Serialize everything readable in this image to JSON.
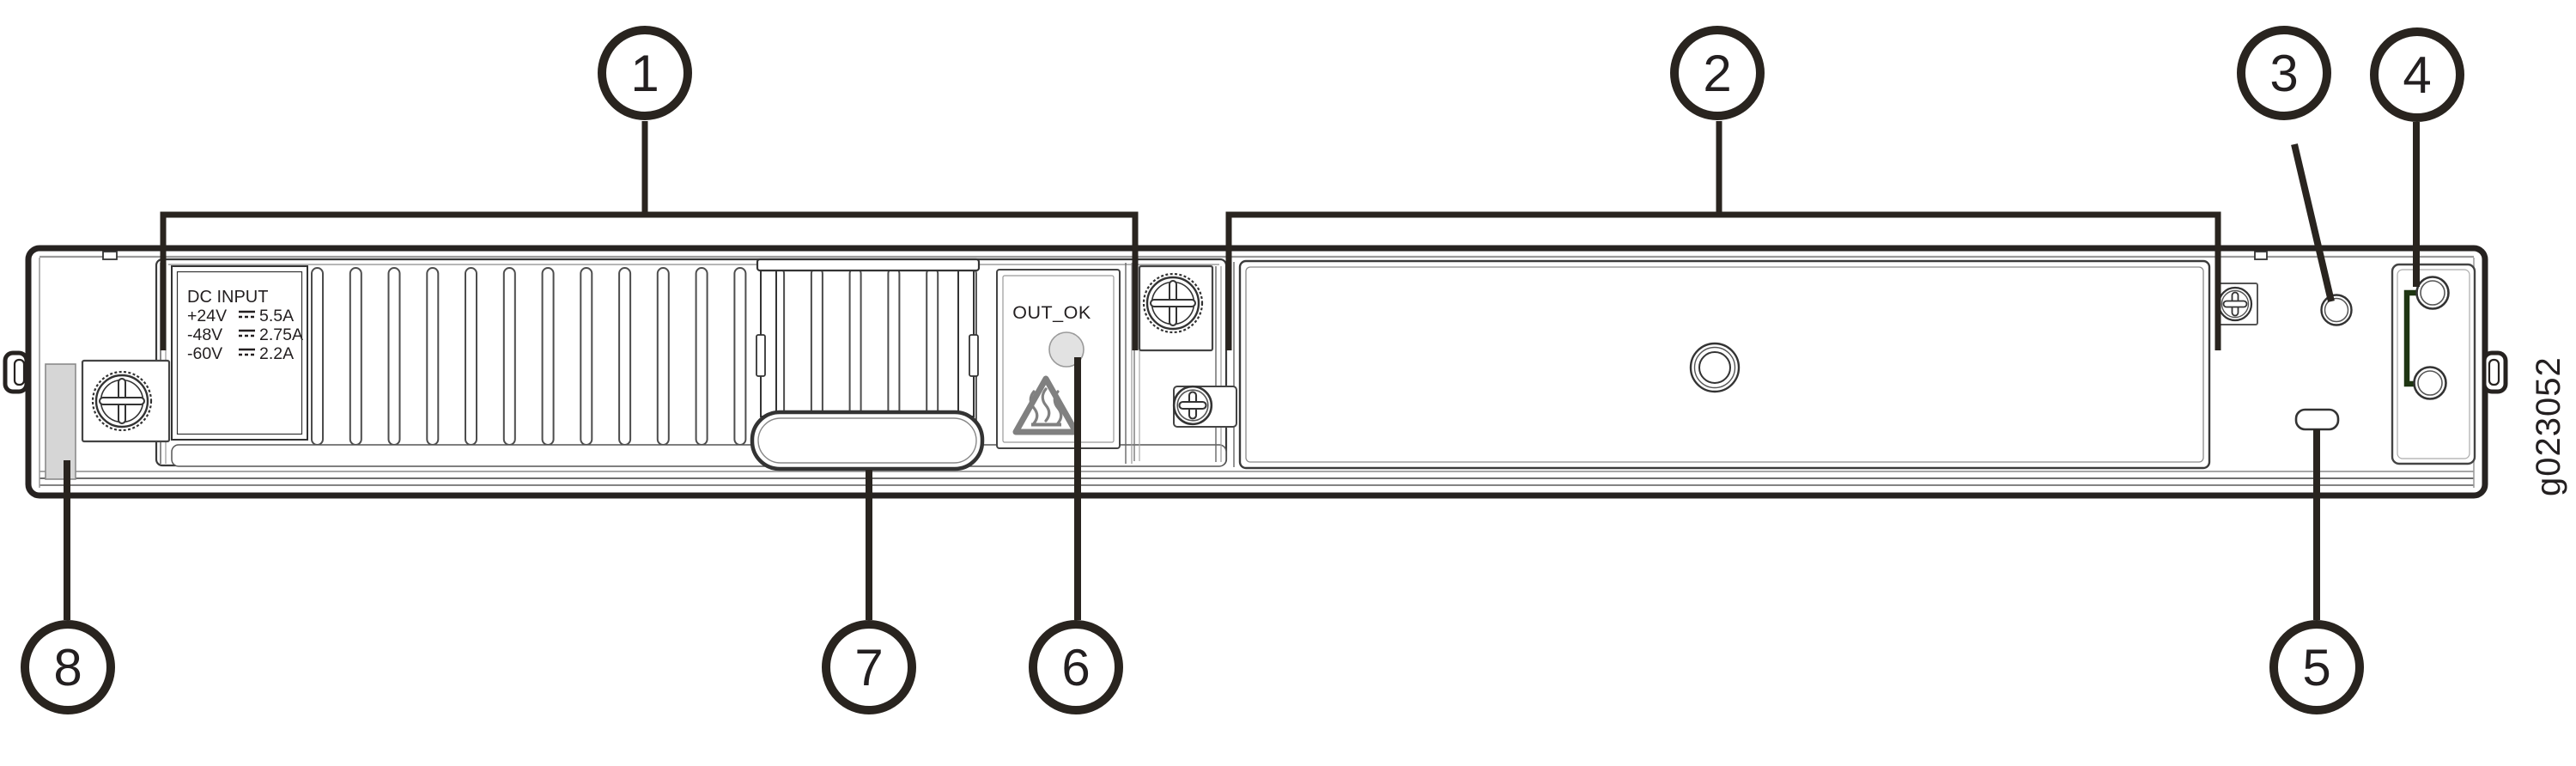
{
  "figure_id": "g023052",
  "callouts": [
    "1",
    "2",
    "3",
    "4",
    "5",
    "6",
    "7",
    "8"
  ],
  "psu_label": {
    "title": "DC INPUT",
    "rows": [
      {
        "voltage": "+24V",
        "current": "5.5A"
      },
      {
        "voltage": "-48V",
        "current": "2.75A"
      },
      {
        "voltage": "-60V",
        "current": "2.2A"
      }
    ]
  },
  "out_ok_label": "OUT_OK",
  "icons": {
    "hot_surface_warning": "heat-wavy-lines-in-triangle",
    "dc_current_symbol": "solid-line-over-dashed-line",
    "thumbscrew": "knurled-captive-screw",
    "phillips_screw": "cross-head-screw"
  },
  "colors": {
    "line_art": "#231f20",
    "grounding_bracket": "#1e3512",
    "led_fill": "#e2e2e2",
    "warning_icon_gray": "#808080",
    "label_strip_fill": "#d6d6d6"
  }
}
